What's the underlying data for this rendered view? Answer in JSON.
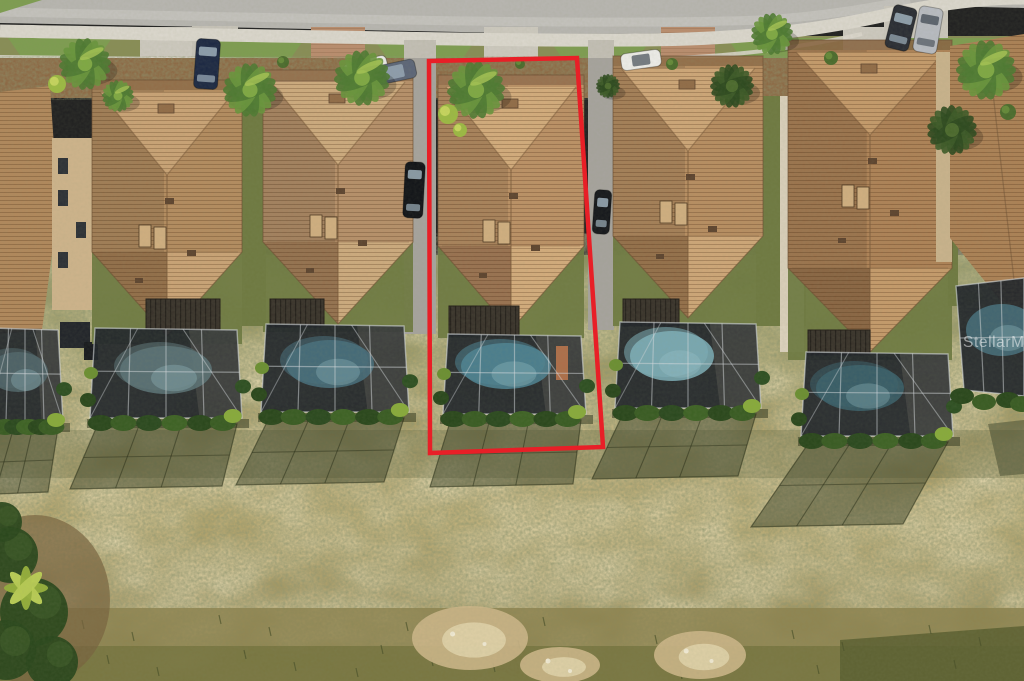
{
  "scene": {
    "watermark": {
      "text": "StellarMLS"
    },
    "highlight": {
      "color": "#e81f27",
      "stroke_width": 4.5,
      "points": [
        [
          429,
          61
        ],
        [
          577,
          58
        ],
        [
          603,
          447
        ],
        [
          430,
          453
        ]
      ]
    },
    "palette": {
      "street": "#b7b5b0",
      "street_worn": "#c6c4bf",
      "sidewalk": "#dad6cc",
      "grass_strip": "#7e9c51",
      "grass_band": "#93995c",
      "mulch": "#8d6a46",
      "lawn_dark": "#6f7a42",
      "alley": "#a6a39d",
      "wall_beige": "#cdb38b",
      "wall_white": "#ddd3c0",
      "wall_tan": "#c2a272",
      "hedge_dark": "#2b481d",
      "hedge_mid": "#3a5c24",
      "hedge_bright": "#88aa3c",
      "cage": "#21262b",
      "cage_frame": "#d6dade",
      "shadow": "#40462c",
      "scrub": "#8b814d",
      "scrub_dark": "#70703c",
      "sand": "#cbb588",
      "sand_light": "#e0d3ac"
    },
    "houses": [
      {
        "id": "house-2",
        "x": 92,
        "w": 150,
        "top": 80,
        "gable_base": 252,
        "apex": 336,
        "roof": "#b38c60",
        "roof_light": "#c9a376",
        "roof_dark": "#926f4a",
        "cage": {
          "x": 95,
          "y": 328,
          "w": 142,
          "h": 90
        },
        "lanai": {
          "x": 146,
          "y": 299,
          "w": 74,
          "h": 31
        },
        "pool": {
          "cx": 166,
          "cy": 370,
          "rx": 46,
          "ry": 24,
          "color": "#5d7478"
        },
        "shadow": {
          "dx": -25,
          "depth": 60
        },
        "driveway": "concrete"
      },
      {
        "id": "house-3",
        "x": 263,
        "w": 150,
        "top": 70,
        "gable_base": 242,
        "apex": 324,
        "roof": "#b6906a",
        "roof_light": "#ccaa7e",
        "roof_dark": "#957250",
        "cage": {
          "x": 266,
          "y": 324,
          "w": 138,
          "h": 88
        },
        "lanai": {
          "x": 270,
          "y": 299,
          "w": 54,
          "h": 28
        },
        "pool": {
          "cx": 330,
          "cy": 364,
          "rx": 44,
          "ry": 24,
          "color": "#49707e"
        },
        "shadow": {
          "dx": -30,
          "depth": 62
        },
        "driveway": "paver"
      },
      {
        "id": "house-4-highlighted",
        "x": 438,
        "w": 146,
        "top": 75,
        "gable_base": 246,
        "apex": 330,
        "roof": "#bb9166",
        "roof_light": "#d2ab7c",
        "roof_dark": "#997251",
        "cage": {
          "x": 448,
          "y": 334,
          "w": 133,
          "h": 80
        },
        "lanai": {
          "x": 449,
          "y": 306,
          "w": 70,
          "h": 30
        },
        "pool": {
          "cx": 506,
          "cy": 366,
          "rx": 45,
          "ry": 23,
          "color": "#4f8494"
        },
        "accent": {
          "x": 556,
          "y": 346,
          "w": 12,
          "h": 34,
          "color": "#c97b4e"
        },
        "shadow": {
          "dx": -18,
          "depth": 62
        },
        "driveway": "concrete",
        "highlighted": true
      },
      {
        "id": "house-5",
        "x": 613,
        "w": 150,
        "top": 56,
        "gable_base": 236,
        "apex": 318,
        "roof": "#b78e62",
        "roof_light": "#cda678",
        "roof_dark": "#94704b",
        "cage": {
          "x": 620,
          "y": 322,
          "w": 136,
          "h": 86
        },
        "lanai": {
          "x": 623,
          "y": 299,
          "w": 56,
          "h": 27
        },
        "pool": {
          "cx": 672,
          "cy": 356,
          "rx": 42,
          "ry": 25,
          "color": "#7fb0ba"
        },
        "shadow": {
          "dx": -28,
          "depth": 60
        },
        "driveway": "paver"
      },
      {
        "id": "house-6",
        "x": 788,
        "w": 164,
        "top": 40,
        "gable_base": 268,
        "apex": 352,
        "roof": "#ad8257",
        "roof_light": "#c49a6b",
        "roof_dark": "#8a6644",
        "cage": {
          "x": 806,
          "y": 352,
          "w": 142,
          "h": 84
        },
        "lanai": {
          "x": 808,
          "y": 330,
          "w": 62,
          "h": 25
        },
        "pool": {
          "cx": 860,
          "cy": 388,
          "rx": 44,
          "ry": 23,
          "color": "#3c616c"
        },
        "shadow": {
          "dx": -55,
          "depth": 80
        },
        "driveway": "concrete"
      }
    ],
    "partial_left": {
      "roof": "#b0885c",
      "wall": {
        "x": 52,
        "y": 138,
        "w": 44,
        "h": 172
      },
      "cage": {
        "x": -8,
        "y": 328,
        "w": 66,
        "h": 94
      },
      "pool": {
        "cx": 18,
        "cy": 372,
        "rx": 30,
        "ry": 20,
        "color": "#51666b"
      }
    },
    "partial_right": {
      "roof": "#ab8156",
      "wall": {
        "x": 936,
        "y": 52,
        "w": 16,
        "h": 210
      },
      "pool": {
        "cx": 1002,
        "cy": 330,
        "rx": 36,
        "ry": 26,
        "color": "#48707c"
      }
    },
    "cars": [
      {
        "x": 207,
        "y": 64,
        "w": 24,
        "h": 50,
        "rot": 4,
        "color": "#1e2a44",
        "glass": "light",
        "name": "suv-navy"
      },
      {
        "x": 366,
        "y": 69,
        "w": 44,
        "h": 19,
        "rot": -14,
        "color": "#e9e9e5",
        "glass": "dark",
        "name": "car-white"
      },
      {
        "x": 395,
        "y": 72,
        "w": 42,
        "h": 19,
        "rot": -12,
        "color": "#5d6678",
        "glass": "light",
        "name": "car-gray-blue"
      },
      {
        "x": 641,
        "y": 60,
        "w": 40,
        "h": 17,
        "rot": -8,
        "color": "#ecebe7",
        "glass": "dark",
        "name": "car-white-2"
      },
      {
        "x": 901,
        "y": 28,
        "w": 24,
        "h": 44,
        "rot": 14,
        "color": "#2b2e35",
        "glass": "light",
        "name": "suv-black"
      },
      {
        "x": 928,
        "y": 30,
        "w": 24,
        "h": 46,
        "rot": 10,
        "color": "#b7bac0",
        "glass": "dark",
        "name": "truck-silver"
      },
      {
        "x": 414,
        "y": 190,
        "w": 20,
        "h": 56,
        "rot": 3,
        "color": "#131519",
        "glass": "light",
        "name": "car-alley-left"
      },
      {
        "x": 602,
        "y": 212,
        "w": 17,
        "h": 44,
        "rot": 4,
        "color": "#17191d",
        "glass": "light",
        "name": "car-alley-right"
      }
    ],
    "palms": [
      {
        "cx": 85,
        "cy": 64,
        "r": 26
      },
      {
        "cx": 118,
        "cy": 96,
        "r": 16
      },
      {
        "cx": 250,
        "cy": 90,
        "r": 27
      },
      {
        "cx": 362,
        "cy": 78,
        "r": 28
      },
      {
        "cx": 476,
        "cy": 90,
        "r": 29
      },
      {
        "cx": 732,
        "cy": 86,
        "r": 22,
        "dark": true
      },
      {
        "cx": 772,
        "cy": 34,
        "r": 21
      },
      {
        "cx": 986,
        "cy": 70,
        "r": 30
      },
      {
        "cx": 952,
        "cy": 130,
        "r": 25,
        "dark": true
      },
      {
        "cx": 608,
        "cy": 86,
        "r": 12,
        "dark": true
      }
    ],
    "bushes": [
      {
        "cx": 57,
        "cy": 84,
        "r": 9,
        "bright": true
      },
      {
        "cx": 448,
        "cy": 114,
        "r": 10,
        "bright": true
      },
      {
        "cx": 460,
        "cy": 130,
        "r": 7,
        "bright": true
      },
      {
        "cx": 283,
        "cy": 62,
        "r": 6
      },
      {
        "cx": 520,
        "cy": 64,
        "r": 5
      },
      {
        "cx": 672,
        "cy": 64,
        "r": 6
      },
      {
        "cx": 831,
        "cy": 58,
        "r": 7
      },
      {
        "cx": 1008,
        "cy": 112,
        "r": 8
      }
    ],
    "street": {
      "islands": [
        60,
        253,
        425,
        600,
        779,
        952
      ]
    },
    "sand_patches": [
      {
        "cx": 470,
        "cy": 638,
        "rx": 58,
        "ry": 32
      },
      {
        "cx": 700,
        "cy": 655,
        "rx": 46,
        "ry": 24
      },
      {
        "cx": 560,
        "cy": 665,
        "rx": 40,
        "ry": 18
      }
    ]
  }
}
